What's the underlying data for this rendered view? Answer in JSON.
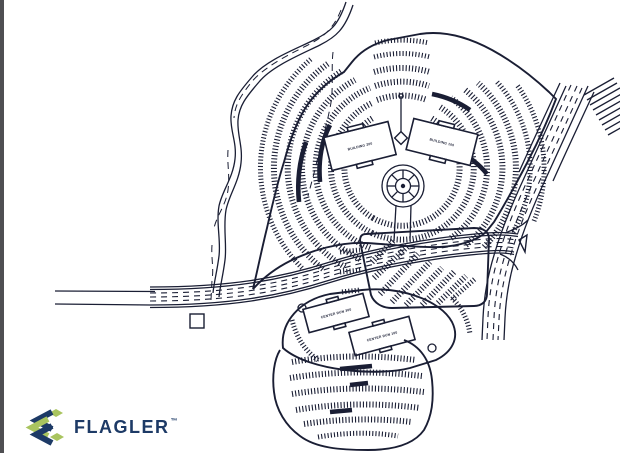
{
  "colors": {
    "ink": "#1a1e34",
    "left_bar": "#4f4f52",
    "background": "#ffffff",
    "logo_navy": "#1d3a66",
    "logo_green": "#a9c45f"
  },
  "logo": {
    "brand": "FLAGLER",
    "trademark": "™"
  },
  "site_plan": {
    "buildings": [
      {
        "id": "building-200",
        "label": "BUILDING 200"
      },
      {
        "id": "building-100",
        "label": "BUILDING 100"
      },
      {
        "id": "center-run-300",
        "label": "CENTER RUN 300"
      },
      {
        "id": "center-run-100",
        "label": "CENTER RUN 100"
      }
    ]
  }
}
